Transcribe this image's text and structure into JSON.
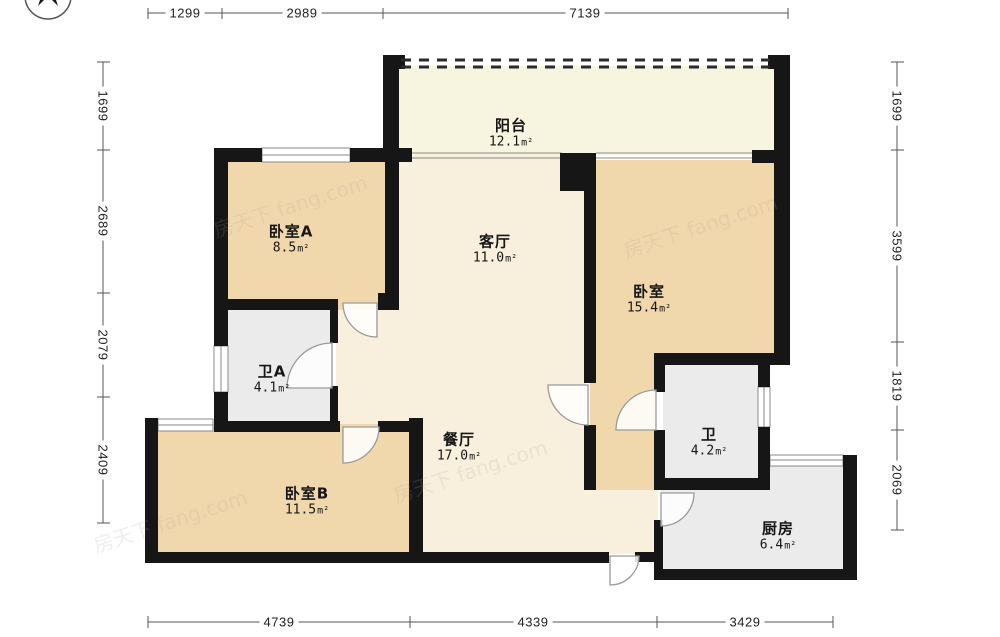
{
  "watermark": {
    "text": "房天下 fang.com"
  },
  "rooms": [
    {
      "id": "balcony",
      "name": "阳台",
      "area": "12.1",
      "unit": "m²"
    },
    {
      "id": "bedroom-a",
      "name": "卧室A",
      "area": "8.5",
      "unit": "m²"
    },
    {
      "id": "living",
      "name": "客厅",
      "area": "11.0",
      "unit": "m²"
    },
    {
      "id": "bedroom",
      "name": "卧室",
      "area": "15.4",
      "unit": "m²"
    },
    {
      "id": "bath-a",
      "name": "卫A",
      "area": "4.1",
      "unit": "m²"
    },
    {
      "id": "dining",
      "name": "餐厅",
      "area": "17.0",
      "unit": "m²"
    },
    {
      "id": "bedroom-b",
      "name": "卧室B",
      "area": "11.5",
      "unit": "m²"
    },
    {
      "id": "bath",
      "name": "卫",
      "area": "4.2",
      "unit": "m²"
    },
    {
      "id": "kitchen",
      "name": "厨房",
      "area": "6.4",
      "unit": "m²"
    }
  ],
  "dimensions": {
    "top": [
      "1299",
      "2989",
      "7139"
    ],
    "bottom": [
      "4739",
      "4339",
      "3429"
    ],
    "left": [
      "1699",
      "2689",
      "2079",
      "2409"
    ],
    "right": [
      "1699",
      "3599",
      "1819",
      "2069"
    ]
  },
  "colors": {
    "wall": "#161616",
    "bedroom_fill": "#f1d7ac",
    "hall_fill": "#f8efdd",
    "balcony_fill": "#f7f5df",
    "wet_room_fill": "#ebebeb"
  }
}
